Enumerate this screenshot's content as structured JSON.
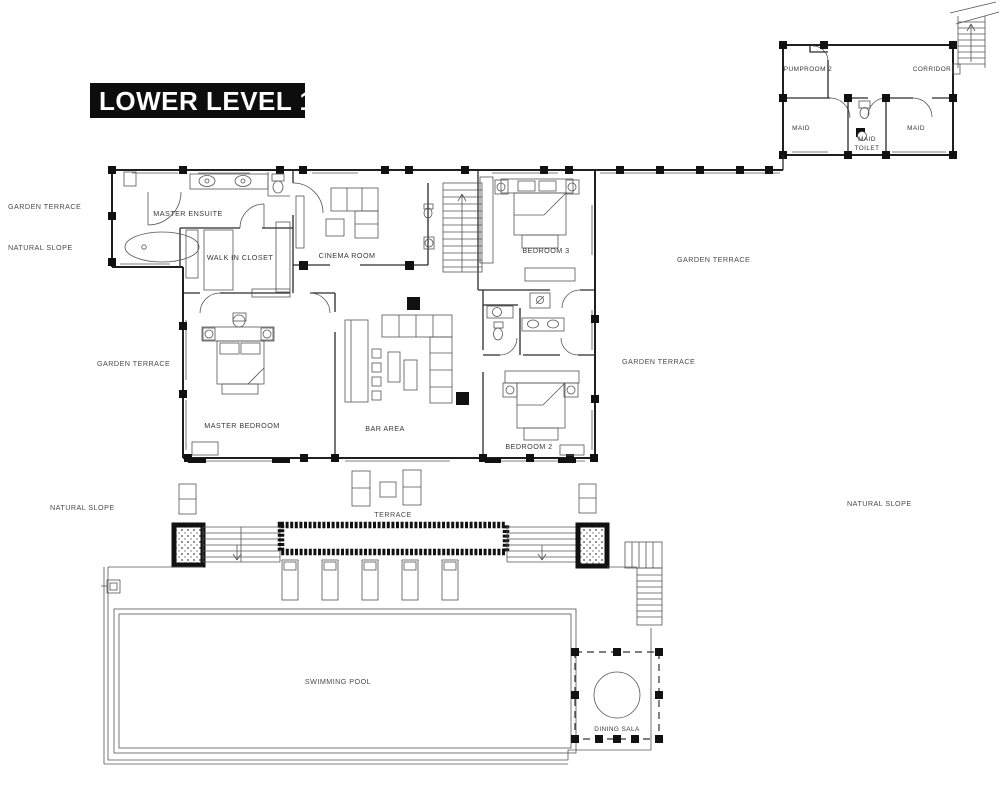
{
  "title": "LOWER LEVEL 1",
  "rooms": {
    "pumproom2": "PUMPROOM 2",
    "corridor": "CORRIDOR",
    "maid_left": "MAID",
    "maid_toilet_line1": "MAID",
    "maid_toilet_line2": "TOILET",
    "maid_right": "MAID",
    "master_ensuite": "MASTER ENSUITE",
    "walk_in_closet": "WALK IN CLOSET",
    "cinema_room": "CINEMA ROOM",
    "bedroom3": "BEDROOM 3",
    "master_bedroom": "MASTER BEDROOM",
    "bar_area": "BAR AREA",
    "bedroom2": "BEDROOM 2",
    "terrace": "TERRACE",
    "swimming_pool": "SWIMMING POOL",
    "dining_sala": "DINING SALA"
  },
  "site": {
    "garden_terrace_nw": "GARDEN TERRACE",
    "natural_slope_nw": "NATURAL SLOPE",
    "garden_terrace_w": "GARDEN TERRACE",
    "garden_terrace_e_upper": "GARDEN TERRACE",
    "garden_terrace_e_lower": "GARDEN TERRACE",
    "natural_slope_sw": "NATURAL SLOPE",
    "natural_slope_se": "NATURAL SLOPE"
  },
  "colors": {
    "background": "#ffffff",
    "wall_ink": "#1f1f1f",
    "title_bg": "#0d0d0d",
    "title_fg": "#ffffff"
  }
}
